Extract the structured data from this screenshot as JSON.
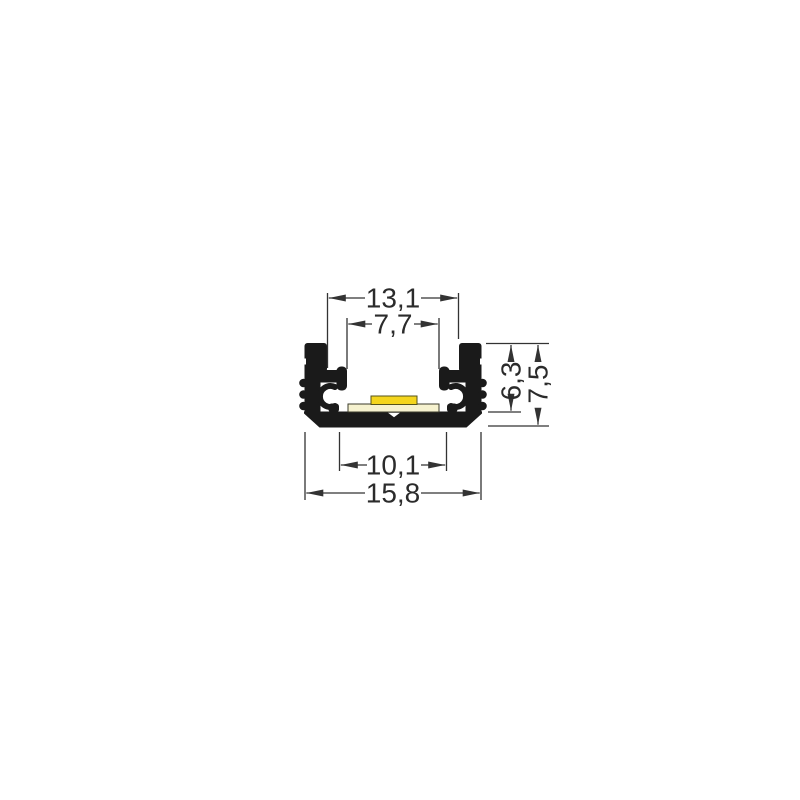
{
  "drawing": {
    "description": "LED aluminium profile cross-section with dimensions",
    "dimensions": {
      "top_outer": "13,1",
      "top_inner": "7,7",
      "side_inner": "6,3",
      "side_outer": "7,5",
      "bottom_inner": "10,1",
      "bottom_outer": "15,8"
    },
    "colors": {
      "profile": "#1a1a1a",
      "pcb": "#f6f2cf",
      "led": "#f4d51d",
      "line": "#333333",
      "text": "#2b2b2b",
      "background": "#ffffff"
    }
  }
}
